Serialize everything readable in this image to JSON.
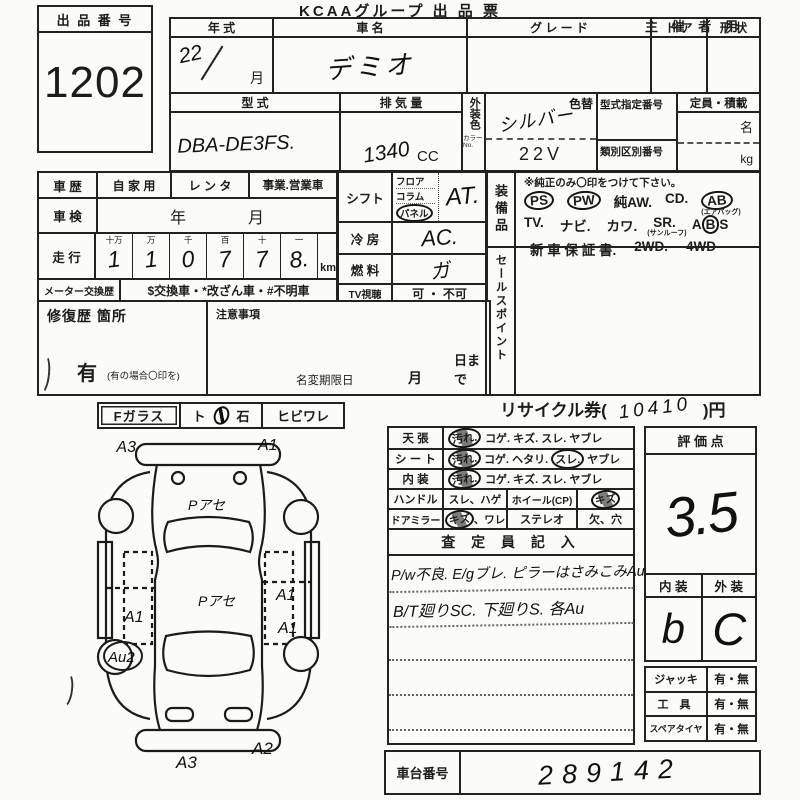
{
  "header": {
    "title": "KCAAグループ 出 品 票",
    "audience": "主 催 者 用"
  },
  "lot": {
    "label": "出 品 番 号",
    "number": "1202"
  },
  "top_table": {
    "year": {
      "label": "年    式",
      "value": "22",
      "month": "月"
    },
    "name": {
      "label": "車    名",
      "value": "デミオ"
    },
    "grade": {
      "label": "グ レ ー ド"
    },
    "door": {
      "label": "ド ア"
    },
    "shape": {
      "label": "形 状"
    },
    "model": {
      "label": "型        式",
      "value": "DBA-DE3FS."
    },
    "displacement": {
      "label": "排 気 量",
      "value": "1340",
      "unit": "CC"
    },
    "ext_color": {
      "label": "外装色",
      "no_label": "カラーNo.",
      "change_label": "色替",
      "value": "シルバー",
      "code": "22V"
    },
    "type_cert": {
      "label": "型式指定番号"
    },
    "class_no": {
      "label": "類別区別番号"
    },
    "capacity": {
      "label": "定員・積載",
      "unit_persons": "名",
      "unit_kg": "kg"
    }
  },
  "history": {
    "car_history": {
      "label": "車 歴",
      "opt1": "自 家 用",
      "opt2": "レ ン タ",
      "opt3": "事業.営業車"
    },
    "inspection": {
      "label": "車 検",
      "year": "年",
      "month": "月"
    },
    "mileage": {
      "label": "走 行",
      "cols": [
        {
          "h": "十万",
          "d": "1"
        },
        {
          "h": "万",
          "d": "1"
        },
        {
          "h": "千",
          "d": "0"
        },
        {
          "h": "百",
          "d": "7"
        },
        {
          "h": "十",
          "d": "7"
        },
        {
          "h": "一",
          "d": "8."
        }
      ],
      "unit": "km"
    },
    "meter": {
      "label": "メーター交換歴",
      "text": "$交換車・*改ざん車・#不明車"
    }
  },
  "repair": {
    "label": "修復歴  箇所",
    "yes": "有",
    "note": "(有の場合〇印を)"
  },
  "caution": {
    "label": "注意事項",
    "deadline_label": "名変期限日",
    "month": "月",
    "day": "日まで"
  },
  "spec": {
    "shift": {
      "label": "シフト",
      "opt1": "フロア",
      "opt2": "コラム",
      "opt3": "パネル",
      "value": "AT."
    },
    "cooling": {
      "label": "冷    房",
      "value": "AC."
    },
    "fuel": {
      "label": "燃    料",
      "value": "ガ"
    },
    "tv": {
      "label": "TV視聴",
      "value": "可 ・ 不可"
    }
  },
  "equipment": {
    "label": "装備品",
    "note": "※純正のみ〇印をつけて下さい。",
    "ps": "PS",
    "pw": "PW",
    "aw": "純AW.",
    "cd": "CD.",
    "ab": "AB",
    "ab_sub": "(エアバッグ)",
    "tv": "TV.",
    "navi": "ナビ.",
    "kawa": "カワ.",
    "sr": "SR.",
    "sr_sub": "(サンルーフ)",
    "abs_a": "A",
    "abs_b": "B",
    "abs_s": "S",
    "warranty": "新 車 保 証 書.",
    "wd2": "2WD.",
    "wd4": "4WD"
  },
  "sales_point": {
    "label": "セールスポイント"
  },
  "f_glass": {
    "label": "Fガラス",
    "opt_a": "ト",
    "opt_b": "石",
    "opt2": "ヒビワレ"
  },
  "recycle": {
    "prefix": "リサイクル券(",
    "value": "10410",
    "suffix": ")円"
  },
  "condition": {
    "ceiling": {
      "label": "天    張",
      "marked": "汚れ.",
      "rest": "コゲ. キズ. スレ. ヤブレ"
    },
    "seat": {
      "label": "シ ー ト",
      "marked": "汚れ.",
      "mid": "コゲ. ヘタリ.",
      "marked2": "スレ.",
      "rest": "ヤブレ"
    },
    "interior": {
      "label": "内    装",
      "marked": "汚れ.",
      "rest": "コゲ. キズ. スレ. ヤブレ"
    },
    "handle": {
      "label": "ハンドル",
      "opt": "スレ、ハゲ",
      "wheel_label": "ホイール(CP)",
      "wheel_mark": "キズ"
    },
    "mirror": {
      "label": "ドアミラー",
      "marked": "キズ",
      "rest": "、ワレ",
      "stereo_label": "ステレオ",
      "stereo_opt": "欠、穴"
    }
  },
  "inspector": {
    "header": "査 定 員 記 入",
    "line1": "P/w不良. E/gブレ. ピラーはさみこみAu",
    "line2": "B/T廻りSC.  下廻りS.  各Au"
  },
  "score": {
    "header": "評  価  点",
    "value": "3.5",
    "interior_label": "内 装",
    "exterior_label": "外 装",
    "interior_value": "b",
    "exterior_value": "C"
  },
  "accessories": {
    "jack": {
      "label": "ジャッキ",
      "value": "有・無"
    },
    "tools": {
      "label": "工  具",
      "value": "有・無"
    },
    "spare": {
      "label": "スペアタイヤ",
      "value": "有・無"
    }
  },
  "chassis": {
    "label": "車台番号",
    "value": "289142"
  },
  "diagram": {
    "front_left": "A3",
    "front_right": "A1",
    "hood": "Pアセ",
    "roof": "Pアセ",
    "left_door": "A1",
    "right_door": "A1",
    "right_rear_door": "A1",
    "rear_wheel": "Au2",
    "rear_left": "A3",
    "rear_right": "A2"
  }
}
